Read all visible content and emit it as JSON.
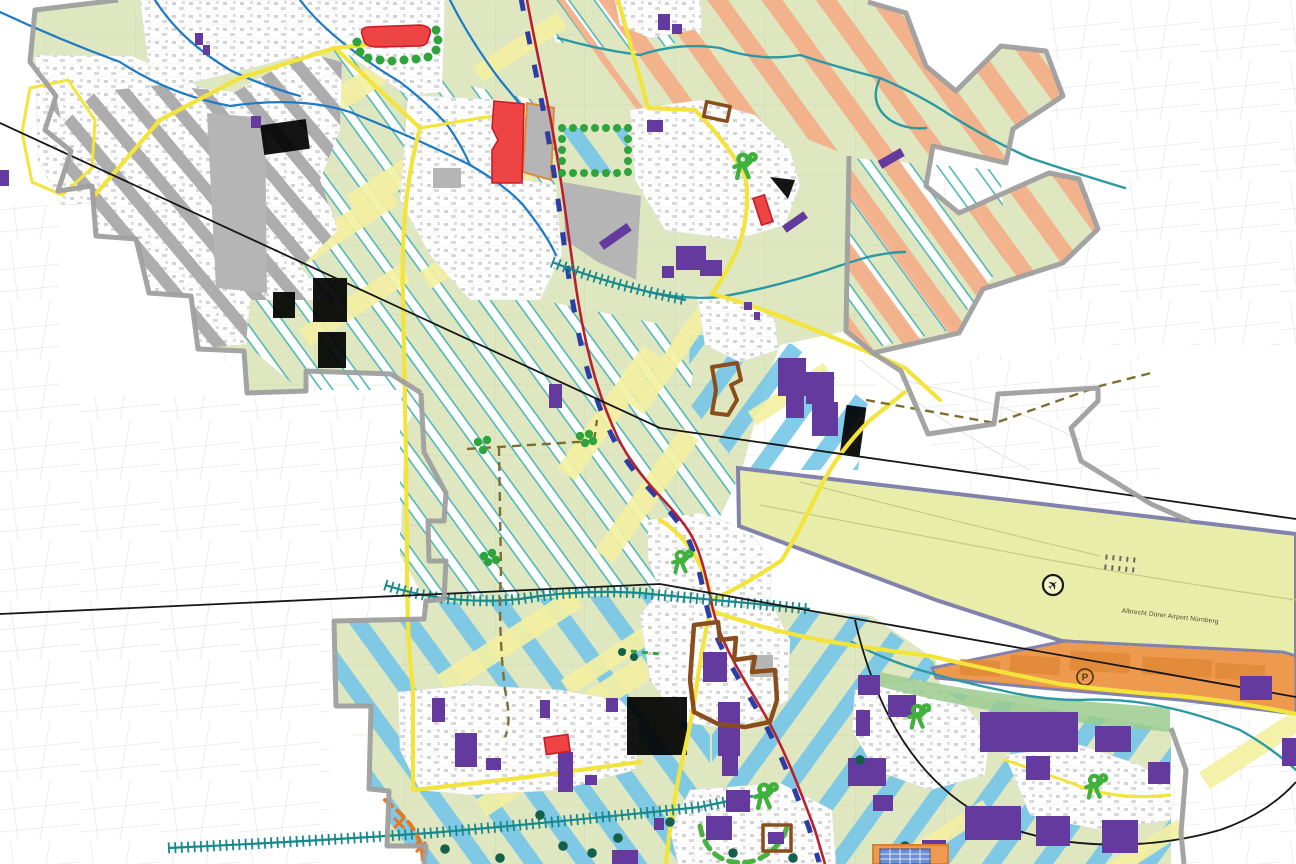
{
  "map": {
    "airport_label": "Albrecht Dürer Airport Nürnberg",
    "parking_symbol": "P",
    "airplane_glyph": "✈",
    "icons": {
      "airport": "airplane-in-circle",
      "parking": "P-in-circle",
      "sports": "green-person-with-ball",
      "crossing": "orange-x-marker"
    },
    "colors": {
      "base_green": "#dfe7c1",
      "stripe_white": "#ffffff",
      "stripe_teal": "#52b7ba",
      "stripe_blue": "#74c6e8",
      "pale_yellow": "#f4f0a2",
      "stripe_orange": "#f3b089",
      "gray_hatch": "#adadad",
      "boundary_gray": "#9f9f9f",
      "building_purple": "#653a9e",
      "planned_red": "#ee4444",
      "planned_red_border": "#c81c28",
      "industrial_orange": "#ee9a4e",
      "industrial_orange_dark": "#e08a38",
      "airport_fill": "#e9edaa",
      "airport_border": "#8282ad",
      "road_yellow": "#f3e43c",
      "water_blue": "#1d7ac6",
      "water_teal": "#2b99a3",
      "rail_red": "#ba1f2e",
      "rail_blue": "#2c3ea6",
      "comb_teal": "#17898d",
      "dot_green": "#2fa43c",
      "tree_dark": "#14604a",
      "person_green": "#3fb13c",
      "dash_green": "#49b13f",
      "brown_outline": "#8a4d1c",
      "dash_brown": "#7d6e33",
      "dash_orange": "#e8761f",
      "black_line": "#161616",
      "gray_fill": "#b5b5b5"
    }
  }
}
